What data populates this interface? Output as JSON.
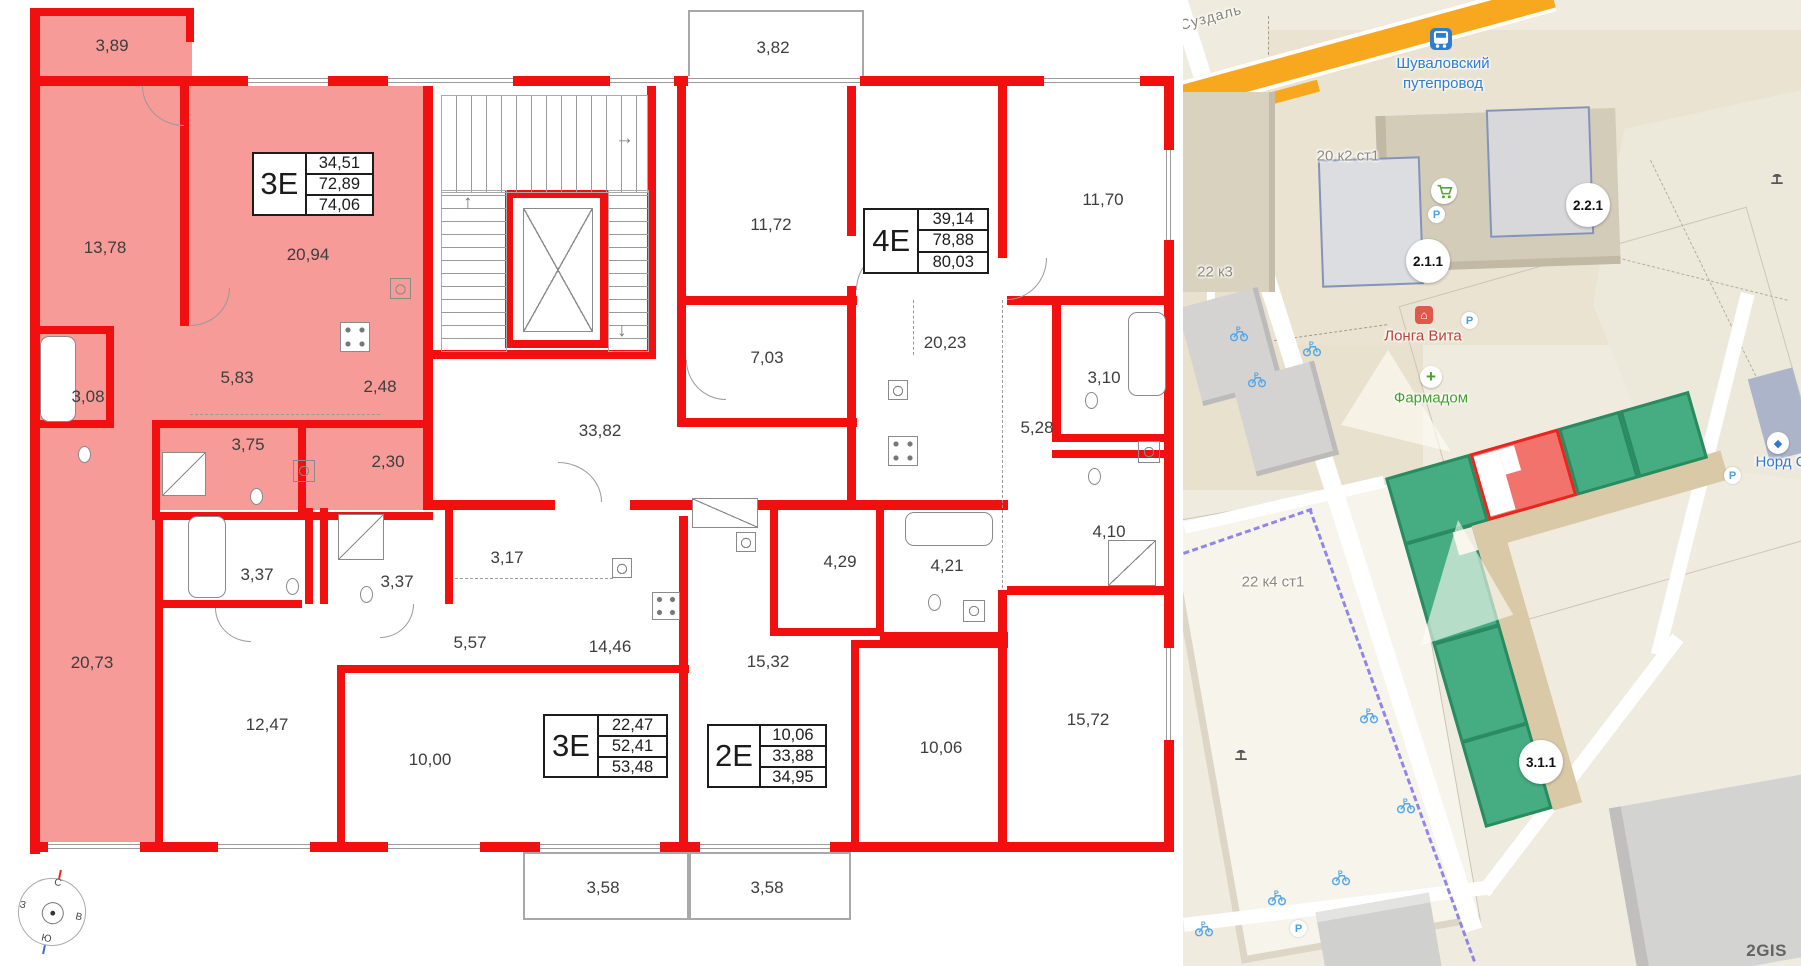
{
  "floor_plan": {
    "apartments": [
      {
        "type": "3Е",
        "values": [
          "34,51",
          "72,89",
          "74,06"
        ],
        "highlighted": true
      },
      {
        "type": "4Е",
        "values": [
          "39,14",
          "78,88",
          "80,03"
        ],
        "highlighted": false
      },
      {
        "type": "3Е",
        "values": [
          "22,47",
          "52,41",
          "53,48"
        ],
        "highlighted": false
      },
      {
        "type": "2Е",
        "values": [
          "10,06",
          "33,88",
          "34,95"
        ],
        "highlighted": false
      }
    ],
    "rooms": [
      {
        "area": "3,89"
      },
      {
        "area": "13,78"
      },
      {
        "area": "20,94"
      },
      {
        "area": "3,08"
      },
      {
        "area": "5,83"
      },
      {
        "area": "2,48"
      },
      {
        "area": "3,75"
      },
      {
        "area": "2,30"
      },
      {
        "area": "20,73"
      },
      {
        "area": "3,37"
      },
      {
        "area": "3,37"
      },
      {
        "area": "3,17"
      },
      {
        "area": "5,57"
      },
      {
        "area": "12,47"
      },
      {
        "area": "10,00"
      },
      {
        "area": "14,46"
      },
      {
        "area": "33,82"
      },
      {
        "area": "3,82"
      },
      {
        "area": "11,72"
      },
      {
        "area": "7,03"
      },
      {
        "area": "20,23"
      },
      {
        "area": "4,29"
      },
      {
        "area": "4,21"
      },
      {
        "area": "15,32"
      },
      {
        "area": "10,06"
      },
      {
        "area": "11,70"
      },
      {
        "area": "3,10"
      },
      {
        "area": "5,28"
      },
      {
        "area": "4,10"
      },
      {
        "area": "15,72"
      },
      {
        "area": "3,58"
      },
      {
        "area": "3,58"
      }
    ],
    "compass": {
      "n": "С",
      "e": "В",
      "s": "Ю",
      "w": "З"
    },
    "colors": {
      "wall": "#f10f0f",
      "highlight": "#f79b98"
    }
  },
  "map": {
    "street": "Суздаль",
    "transit_stop": "Шуваловский путепровод",
    "buildings": {
      "b1": "20 к2 ст1",
      "b2": "22 к3",
      "b3": "22 к4 ст1"
    },
    "badges": {
      "b211": "2.1.1",
      "b221": "2.2.1",
      "b311": "3.1.1"
    },
    "pois": {
      "longa": "Лонга Вита",
      "pharm": "Фармадом",
      "nord": "Норд С"
    },
    "logo": "2GIS",
    "colors": {
      "selected": "#f2736c",
      "green": "#46ac82",
      "road_orange": "#f7a81f",
      "bike_path": "#9186e8",
      "transit": "#2d7dd2",
      "poi_red": "#bb4237",
      "poi_green": "#43a02f",
      "poi_blue": "#3577d0"
    }
  }
}
